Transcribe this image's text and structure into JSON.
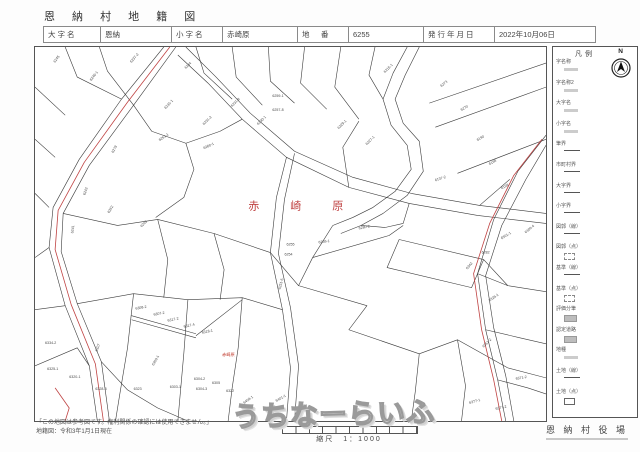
{
  "header": {
    "title": "恩 納 村 地 籍 図",
    "oaza_label": "大字名",
    "oaza_value": "恩納",
    "koaza_label": "小字名",
    "koaza_value": "赤崎原",
    "chiban_label": "地　番",
    "chiban_value": "6255",
    "issue_label": "発行年月日",
    "issue_value": "2022年10月06日"
  },
  "legend": {
    "title": "凡例",
    "north_label": "N",
    "items": [
      {
        "label": "字名称",
        "sample": "text"
      },
      {
        "label": "字名称2",
        "sample": "text"
      },
      {
        "label": "大字名",
        "sample": "text"
      },
      {
        "label": "小字名",
        "sample": "text"
      },
      {
        "label": "筆界",
        "sample": "line"
      },
      {
        "label": "市町村界",
        "sample": "line"
      },
      {
        "label": "大字界",
        "sample": "line"
      },
      {
        "label": "小字界",
        "sample": "line"
      },
      {
        "label": "図郭（線）",
        "sample": "line"
      },
      {
        "label": "図郭（点）",
        "sample": "dashbox"
      },
      {
        "label": "基準（線）",
        "sample": "line"
      },
      {
        "label": "基準（点）",
        "sample": "dashbox"
      },
      {
        "label": "評価分筆",
        "sample": "graybox"
      },
      {
        "label": "認定道路",
        "sample": "graybox"
      },
      {
        "label": "地種",
        "sample": "text"
      },
      {
        "label": "土地（線）",
        "sample": "line"
      },
      {
        "label": "土地（点）",
        "sample": "box"
      }
    ]
  },
  "footer": {
    "note1": "「この地図は参考図です。権利関係の確認には使用できません。」",
    "note2": "地籍図：令和3年1月1日現在",
    "scale_label": "縮尺　1：1000",
    "office": "恩 納 村 役 場"
  },
  "watermark": {
    "text": "うちなーらいふ"
  },
  "map": {
    "area_label": "赤 崎 原",
    "area_label_x": 212,
    "area_label_y": 162,
    "small_label": "赤崎原",
    "small_label_x": 186,
    "small_label_y": 308,
    "lines": [
      "128,0 86,52 44,112 18,160 14,200 30,258 54,318 62,373",
      "140,0 98,58 54,118 28,166 26,204 42,256 66,314 74,373",
      "150,0 180,30 214,66 258,104 316,130 374,146 442,158 508,166",
      "142,8 172,36 206,72 250,110 312,140 372,156 440,168 508,176",
      "250,110 240,150 234,205 246,262 254,320 250,373",
      "258,106 248,152 242,206 254,260 262,318 258,373",
      "508,88 480,124 456,172 440,226 448,282 460,332 468,373",
      "508,98 488,132 464,178 448,228 456,280 468,328 476,373",
      "370,0 356,26 346,52 354,78 370,98 374,122 358,144 336,160 316,170 296,178",
      "382,0 368,28 358,52 366,76 382,94 386,124 370,148 346,166 324,178 304,186",
      "392,56 508,16",
      "398,80 508,40",
      "420,126 508,92",
      "442,158 472,132",
      "30,0 42,30 86,52",
      "64,0 72,24 98,58",
      "160,0 168,26 196,52",
      "196,0 200,30 226,58",
      "232,0 234,34 258,56",
      "268,0 264,36 290,62",
      "304,0 298,40 322,72",
      "338,0 332,28 346,52",
      "0,40 30,68",
      "0,92 20,110",
      "0,146 14,160",
      "0,210 14,200",
      "0,262 30,258",
      "0,318 42,300 54,318",
      "98,58 116,84 150,96 184,84 206,72",
      "150,96 158,122 148,150 120,170",
      "28,166 82,178 122,172 178,186 234,205",
      "42,256 98,246 152,252 206,250 246,262",
      "122,172 132,212 128,250",
      "98,246 92,300 84,348 80,373",
      "152,252 148,305 142,373",
      "66,314 92,342 122,360 152,373",
      "206,250 202,300 196,340 192,373",
      "312,140 306,100 322,74",
      "372,156 366,176 348,180 324,178",
      "296,178 276,210 262,238",
      "262,238 330,258 312,282 382,306 420,292 470,320",
      "420,292 428,338 424,373",
      "470,320 508,330",
      "382,306 378,344 374,373",
      "440,226 470,238 508,244",
      "448,282 482,290 508,296",
      "460,332 490,340 508,346",
      "234,205 262,238",
      "178,186 188,222 184,252",
      "96,268 160,286",
      "96,272 160,290",
      "160,288 206,252",
      "276,210 352,188 366,178",
      "362,192 446,212 434,240 350,220 362,192",
      "446,212 470,238"
    ],
    "red_lines": [
      "134,0 92,55 49,115 23,163 20,202 36,257 60,316 68,373",
      "504,92 476,128 452,176 436,226 444,282 456,332 464,373",
      "20,340 34,360 30,373"
    ],
    "labels": [
      {
        "t": "6245",
        "x": 20,
        "y": 16,
        "r": -55
      },
      {
        "t": "6246-1",
        "x": 56,
        "y": 34,
        "r": -52
      },
      {
        "t": "6237-2",
        "x": 96,
        "y": 16,
        "r": -50
      },
      {
        "t": "6244",
        "x": 150,
        "y": 22,
        "r": -45
      },
      {
        "t": "6231-1",
        "x": 130,
        "y": 62,
        "r": -48
      },
      {
        "t": "6231-2",
        "x": 168,
        "y": 78,
        "r": -45
      },
      {
        "t": "6231-8",
        "x": 196,
        "y": 60,
        "r": -45
      },
      {
        "t": "6230-1",
        "x": 222,
        "y": 78,
        "r": -45
      },
      {
        "t": "6259-1",
        "x": 236,
        "y": 50,
        "r": 0
      },
      {
        "t": "6257-8",
        "x": 236,
        "y": 64,
        "r": 0
      },
      {
        "t": "6260-1",
        "x": 168,
        "y": 102,
        "r": -25
      },
      {
        "t": "6261-1",
        "x": 124,
        "y": 94,
        "r": -35
      },
      {
        "t": "6278",
        "x": 78,
        "y": 106,
        "r": -62
      },
      {
        "t": "6242",
        "x": 50,
        "y": 148,
        "r": -72
      },
      {
        "t": "6241",
        "x": 38,
        "y": 186,
        "r": -82
      },
      {
        "t": "6262",
        "x": 74,
        "y": 166,
        "r": -60
      },
      {
        "t": "6263",
        "x": 106,
        "y": 180,
        "r": -45
      },
      {
        "t": "6215-1",
        "x": 348,
        "y": 26,
        "r": -45
      },
      {
        "t": "6273",
        "x": 404,
        "y": 40,
        "r": -38
      },
      {
        "t": "6270",
        "x": 424,
        "y": 64,
        "r": -32
      },
      {
        "t": "6190",
        "x": 440,
        "y": 94,
        "r": -32
      },
      {
        "t": "6198",
        "x": 452,
        "y": 118,
        "r": -30
      },
      {
        "t": "6199",
        "x": 464,
        "y": 142,
        "r": -28
      },
      {
        "t": "6137-2",
        "x": 398,
        "y": 134,
        "r": -18
      },
      {
        "t": "6227-1",
        "x": 330,
        "y": 98,
        "r": -45
      },
      {
        "t": "6229-1",
        "x": 302,
        "y": 82,
        "r": -45
      },
      {
        "t": "6280-2",
        "x": 322,
        "y": 182,
        "r": -12
      },
      {
        "t": "6255",
        "x": 250,
        "y": 198,
        "r": 0
      },
      {
        "t": "6254",
        "x": 248,
        "y": 208,
        "r": 0
      },
      {
        "t": "6258-1",
        "x": 282,
        "y": 196,
        "r": -8
      },
      {
        "t": "6251-5",
        "x": 244,
        "y": 242,
        "r": -75
      },
      {
        "t": "6282",
        "x": 444,
        "y": 206,
        "r": 0
      },
      {
        "t": "6342",
        "x": 430,
        "y": 222,
        "r": -50
      },
      {
        "t": "6351-2",
        "x": 446,
        "y": 300,
        "r": -45
      },
      {
        "t": "6301-1",
        "x": 464,
        "y": 192,
        "r": -32
      },
      {
        "t": "6309-4",
        "x": 488,
        "y": 186,
        "r": -40
      },
      {
        "t": "6326-1",
        "x": 452,
        "y": 254,
        "r": -35
      },
      {
        "t": "6371-2",
        "x": 478,
        "y": 332,
        "r": -10
      },
      {
        "t": "6377-1",
        "x": 432,
        "y": 356,
        "r": -15
      },
      {
        "t": "6377-2",
        "x": 458,
        "y": 362,
        "r": -12
      },
      {
        "t": "6409-1",
        "x": 208,
        "y": 356,
        "r": -35
      },
      {
        "t": "6401-1",
        "x": 240,
        "y": 354,
        "r": -30
      },
      {
        "t": "6334-2",
        "x": 10,
        "y": 296,
        "r": 0
      },
      {
        "t": "6327",
        "x": 62,
        "y": 304,
        "r": -70
      },
      {
        "t": "6308-2",
        "x": 100,
        "y": 262,
        "r": -10
      },
      {
        "t": "6307-2",
        "x": 118,
        "y": 268,
        "r": -10
      },
      {
        "t": "6317-2",
        "x": 132,
        "y": 274,
        "r": -12
      },
      {
        "t": "6317-4",
        "x": 148,
        "y": 280,
        "r": -12
      },
      {
        "t": "6318-1",
        "x": 166,
        "y": 286,
        "r": -12
      },
      {
        "t": "6325-1",
        "x": 12,
        "y": 322,
        "r": 0
      },
      {
        "t": "6320-1",
        "x": 34,
        "y": 330,
        "r": 0
      },
      {
        "t": "6328-3",
        "x": 60,
        "y": 342,
        "r": 0
      },
      {
        "t": "6309-1",
        "x": 118,
        "y": 318,
        "r": -60
      },
      {
        "t": "6323",
        "x": 98,
        "y": 342,
        "r": 0
      },
      {
        "t": "6303-1",
        "x": 134,
        "y": 340,
        "r": 0
      },
      {
        "t": "6304-2",
        "x": 158,
        "y": 332,
        "r": 0
      },
      {
        "t": "6304-3",
        "x": 160,
        "y": 342,
        "r": 0
      },
      {
        "t": "6305",
        "x": 176,
        "y": 336,
        "r": 0
      },
      {
        "t": "6322",
        "x": 190,
        "y": 344,
        "r": 0
      }
    ]
  }
}
